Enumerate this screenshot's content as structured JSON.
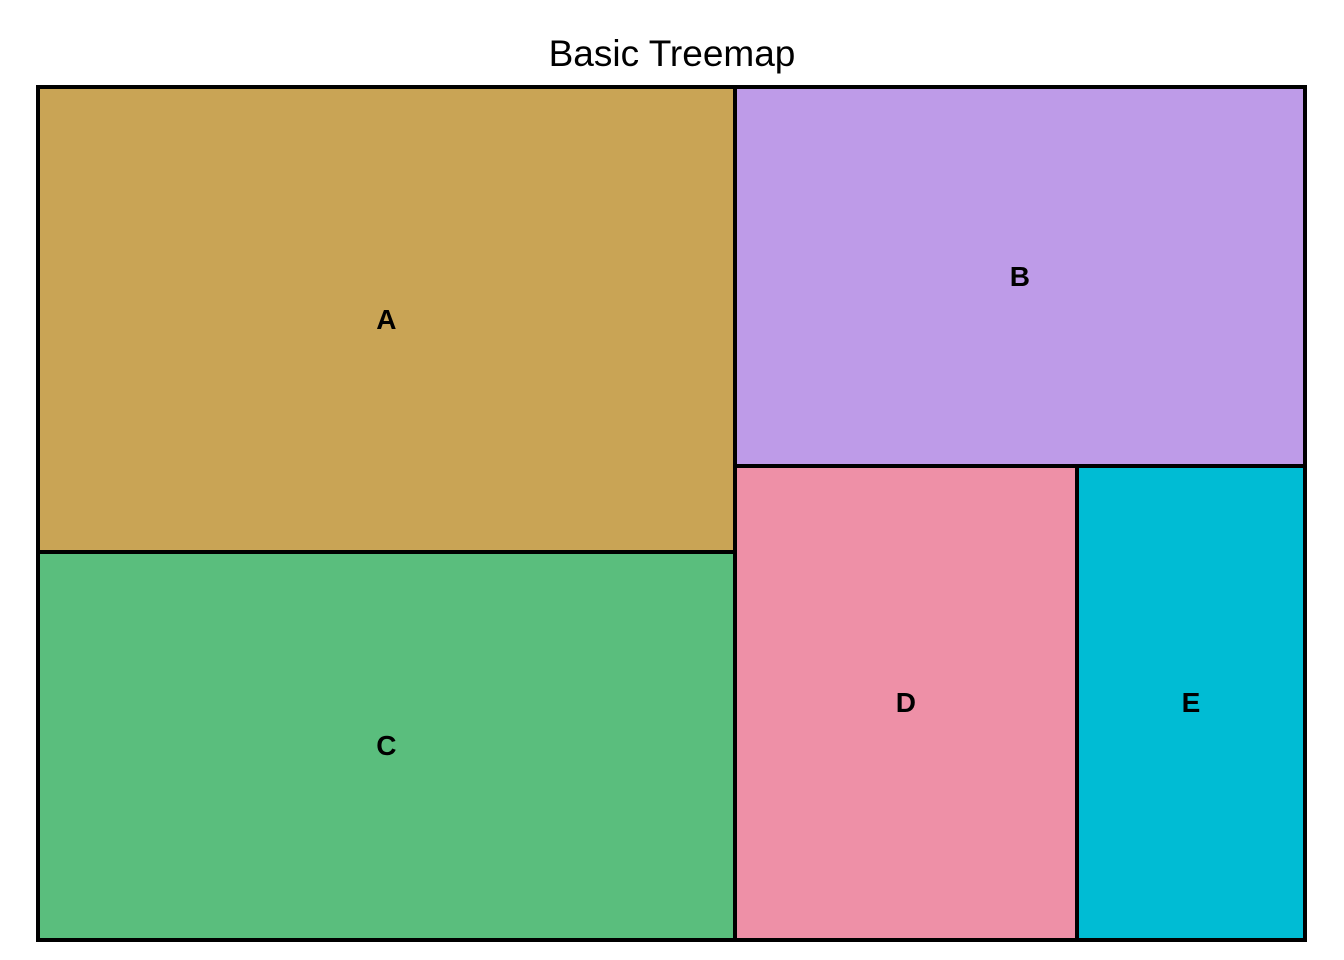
{
  "chart_data": {
    "type": "treemap",
    "title": "Basic Treemap",
    "items": [
      {
        "label": "A",
        "value": 30,
        "color": "#C9A455"
      },
      {
        "label": "B",
        "value": 20,
        "color": "#BE9BE8"
      },
      {
        "label": "C",
        "value": 25,
        "color": "#5ABE7D"
      },
      {
        "label": "D",
        "value": 15,
        "color": "#EE90A7"
      },
      {
        "label": "E",
        "value": 10,
        "color": "#00BCD4"
      }
    ],
    "total": 100,
    "layout_hint": {
      "left_column": [
        "A",
        "C"
      ],
      "right_column": [
        "B",
        [
          "D",
          "E"
        ]
      ]
    },
    "border_color": "#000000",
    "label_color": "#000000",
    "title_color": "#000000",
    "background_color": "#FFFFFF"
  }
}
